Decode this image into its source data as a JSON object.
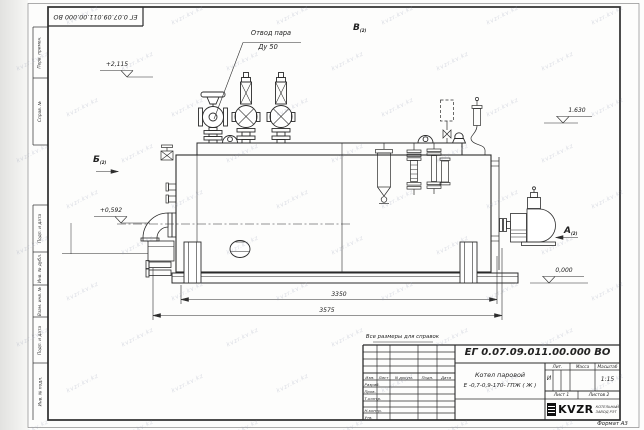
{
  "watermark": {
    "text": "kvzr.kv.kz"
  },
  "frame": {
    "top_designation": "ЕГ 0.07.09.011.00.000  ВО",
    "format_label": "Формат А3",
    "left_labels": [
      "Перв. примен.",
      "Справ. №",
      "Подп. и дата",
      "Инв. № дубл.",
      "Взам. инв. №",
      "Подп. и дата",
      "Инв. № подл."
    ]
  },
  "drawing": {
    "labels": {
      "steam_outlet_line1": "Отвод пара",
      "steam_outlet_line2": "Ду 50",
      "view_b": "Б",
      "view_b_sub": "(2)",
      "view_v": "В",
      "view_v_sub": "(2)",
      "view_a": "А",
      "view_a_sub": "(2)",
      "elev_top": "+2,115",
      "elev_mid": "+0,592",
      "elev_right": "1.630",
      "elev_zero": "0,000",
      "dim_inner": "3350",
      "dim_outer": "3575",
      "note": "Все размеры для справок"
    }
  },
  "title_block": {
    "designation": "ЕГ 0.07.09.011.00.000  ВО",
    "product_name_line1": "Котел паровой",
    "product_name_line2": "Е -0,7-0,9-170- ГПЖ ( Ж )",
    "columns": {
      "izm": "Изм.",
      "list": "Лист",
      "ndoc": "N докум.",
      "podp": "Подп.",
      "data": "Дата"
    },
    "rows": {
      "r1": "Разраб.",
      "r2": "Пров.",
      "r3": "Т.контр.",
      "r4": "Н.контр.",
      "r5": "Утв."
    },
    "lit_header": "Лит.",
    "mass_header": "Масса",
    "scale_header": "Масштаб",
    "lit_value": "И",
    "scale_value": "1:15",
    "sheet_label": "Лист 1",
    "sheets_label": "Листов 2",
    "logo_text": "KVZR",
    "logo_caption_line1": "КОТЕЛЬНЫЙ",
    "logo_caption_line2": "ЗАВОД РЭТ"
  }
}
